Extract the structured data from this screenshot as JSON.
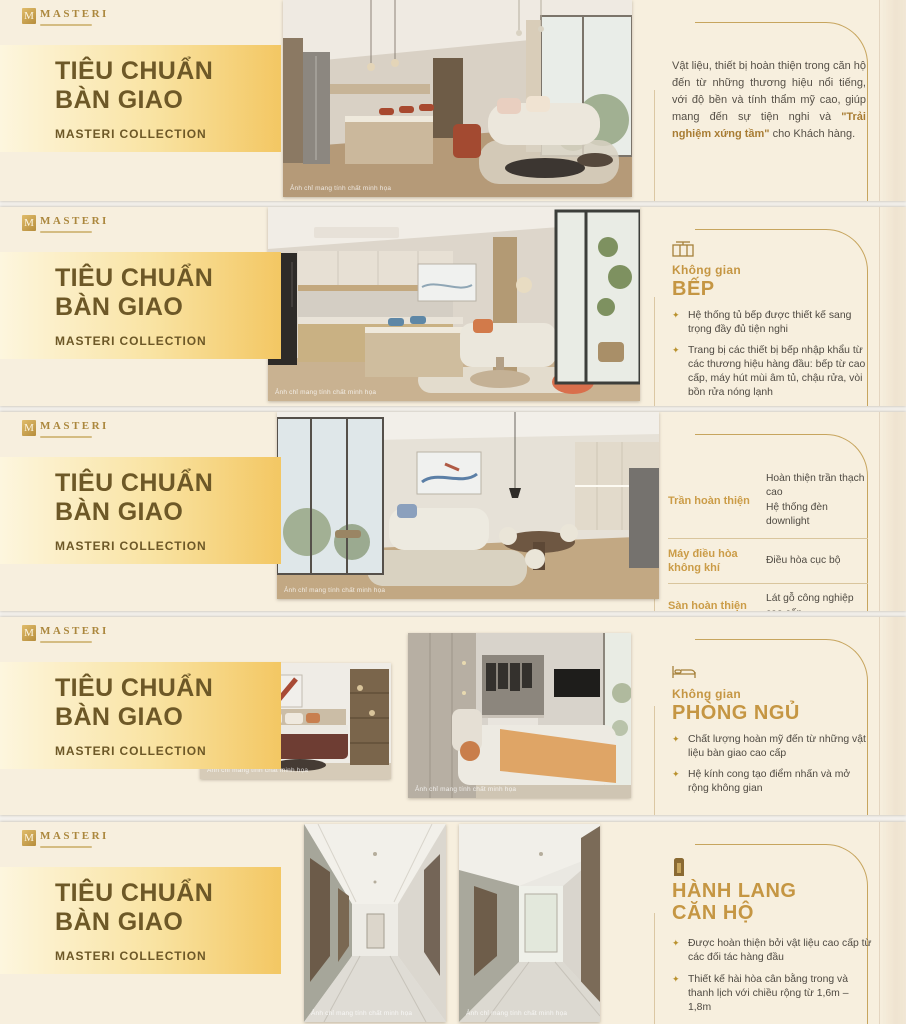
{
  "brand": {
    "name": "MASTERI",
    "mark": "M"
  },
  "banner": {
    "title_line1": "TIÊU CHUẨN",
    "title_line2": "BÀN GIAO",
    "subtitle": "MASTERI COLLECTION"
  },
  "photo_caption": "Ảnh chỉ mang tính chất minh họa",
  "glyphs": {
    "bullet": "✦"
  },
  "colors": {
    "slide_bg": "#f7efde",
    "banner_gold": "#f3c763",
    "title_brown": "#6d5827",
    "heading_gold": "#c59643",
    "body_text": "#4f4a42",
    "accent_line": "#c7a55e"
  },
  "slides": [
    {
      "name": "intro",
      "paragraph": {
        "before": "Vật liệu, thiết bị hoàn thiện trong căn hộ đến từ những thương hiệu nổi tiếng, với độ bền và tính thẩm mỹ cao, giúp mang đến sự tiện nghi và ",
        "highlight": "\"Trải nghiệm xứng tầm\"",
        "after": " cho Khách hàng."
      }
    },
    {
      "name": "kitchen",
      "icon": "kitchen-icon",
      "eyebrow": "Không gian",
      "heading": "BẾP",
      "bullets": [
        "Hệ thống tủ bếp được thiết kế sang trọng đầy đủ tiện nghi",
        "Trang bị các thiết bị bếp nhập khẩu từ các thương hiệu hàng đầu: bếp từ cao cấp, máy hút mùi âm tủ, chậu rửa, vòi bồn rửa nóng lạnh",
        "Tường tủ bếp: vách bếp kính cường lực",
        "Mặt bếp được lát đá"
      ]
    },
    {
      "name": "specs",
      "rows": [
        {
          "label": "Trần hoàn thiện",
          "value": "Hoàn thiện trần thạch cao",
          "value2": "Hệ thống đèn downlight"
        },
        {
          "label": "Máy điều hòa không khí",
          "value": "Điều hòa cục bộ"
        },
        {
          "label": "Sàn hoàn thiện",
          "value": "Lát gỗ công nghiệp cao cấp"
        },
        {
          "label": "Ban công kính",
          "value": "Mở rộng không gian, tối đa tầm nhìn"
        }
      ]
    },
    {
      "name": "bedroom",
      "icon": "bed-icon",
      "eyebrow": "Không gian",
      "heading": "PHÒNG NGỦ",
      "bullets": [
        "Chất lượng hoàn mỹ đến từ những vật liệu bàn giao cao cấp",
        "Hệ kính cong tạo điểm nhấn và mở rộng không gian"
      ]
    },
    {
      "name": "hallway",
      "icon": "door-icon",
      "heading_line1": "HÀNH LANG",
      "heading_line2": "CĂN HỘ",
      "bullets": [
        "Được hoàn thiện bởi vật liệu cao cấp từ các đối tác hàng đầu",
        "Thiết kế hài hòa cân bằng trong và thanh lịch với chiều rộng từ 1,6m – 1,8m",
        "Được trang bị điều hòa âm trần và hệ thống ánh sáng sang trọng"
      ]
    }
  ]
}
